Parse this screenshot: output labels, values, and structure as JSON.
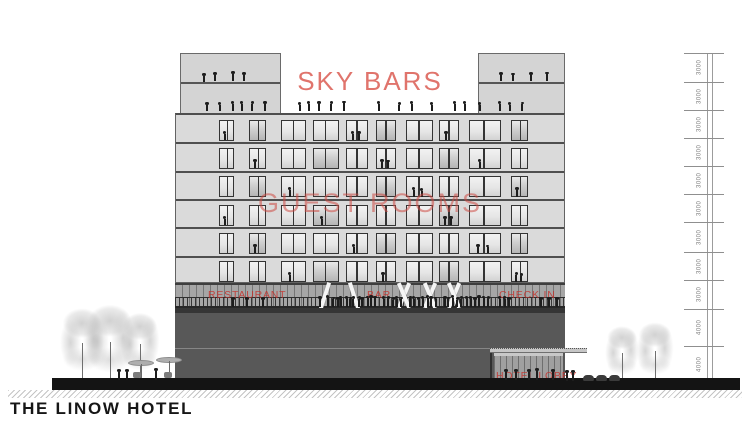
{
  "title": "THE LINOW HOTEL",
  "zone_labels": {
    "sky_bars": "SKY BARS",
    "guest_rooms": "GUEST ROOMS",
    "restaurant": "RESTAURANT",
    "bar": "BAR",
    "check_in": "CHECK IN",
    "hotel_lobby": "HOTEL LOBBY"
  },
  "dimensions": {
    "unit": "mm",
    "segments": [
      "3000",
      "3000",
      "3000",
      "3000",
      "3000",
      "3000",
      "3000",
      "3000",
      "3000",
      "4000",
      "4000"
    ]
  },
  "building": {
    "guest_room_floors": 6,
    "windows_per_floor": 10,
    "sky_bar_levels": 2
  },
  "colors": {
    "accent_red": "#d95348",
    "facade_gray": "#dadada",
    "band_gray": "#a6a6a6",
    "podium_gray": "#585858",
    "ground_black": "#141414"
  }
}
